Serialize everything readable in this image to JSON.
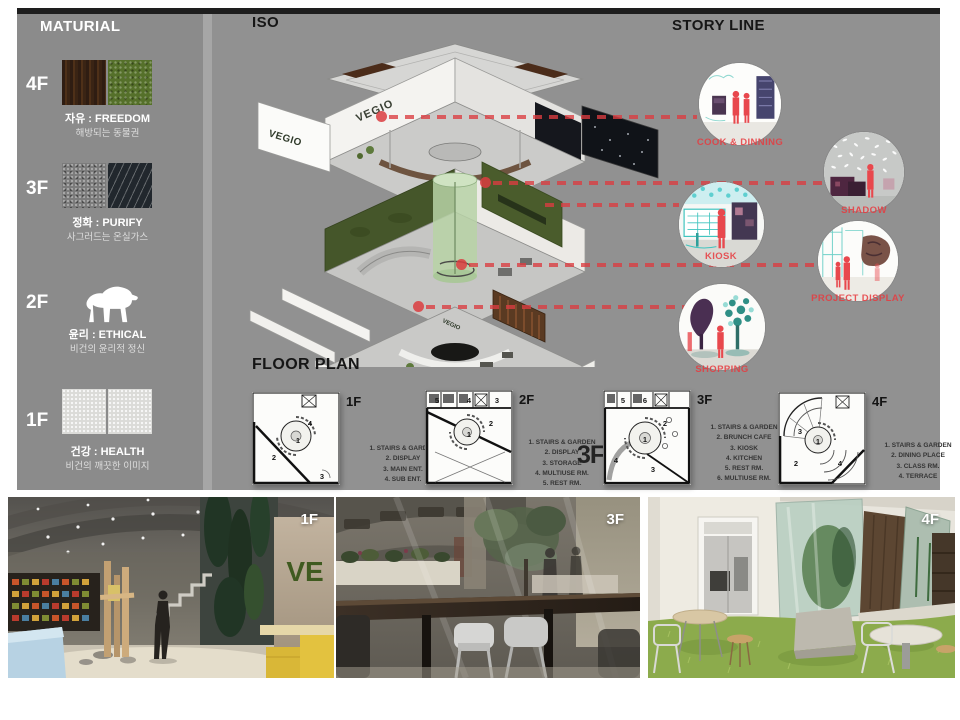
{
  "page": {
    "background": "#ffffff",
    "board_gray": "#919191",
    "sidebar_gray": "#8b8b8b",
    "accent_red": "#db3c40"
  },
  "sidebar": {
    "title": "MATURIAL",
    "items": [
      {
        "floor": "4F",
        "theme": "자유 : FREEDOM",
        "desc": "해방되는 동물권",
        "swatches": [
          "dark-wood",
          "green-grass"
        ]
      },
      {
        "floor": "3F",
        "theme": "정화 : PURIFY",
        "desc": "사그러드는 온실가스",
        "swatches": [
          "gray-concrete",
          "rain-streak"
        ]
      },
      {
        "floor": "2F",
        "theme": "윤리 : ETHICAL",
        "desc": "비건의 윤리적 정신",
        "icon": "polar-bear"
      },
      {
        "floor": "1F",
        "theme": "건강 : HEALTH",
        "desc": "비건의 깨끗한 이미지",
        "swatches": [
          "white-plaster",
          "white-plaster"
        ]
      }
    ]
  },
  "iso": {
    "title": "ISO",
    "logo": "VEGIO"
  },
  "storyline": {
    "title": "STORY LINE",
    "scenes": [
      {
        "label": "COOK & DINNING"
      },
      {
        "label": "SHADOW"
      },
      {
        "label": "KIOSK"
      },
      {
        "label": "PROJECT DISPLAY"
      },
      {
        "label": "SHOPPING"
      }
    ]
  },
  "floorplan": {
    "title": "FLOOR PLAN",
    "big_label": "3F",
    "plans": [
      {
        "floor": "1F",
        "rooms": [
          "1",
          "2",
          "3",
          "4"
        ],
        "legend": [
          "1. STAIRS & GARDEN",
          "2. DISPLAY",
          "3. MAIN ENT.",
          "4. SUB ENT."
        ]
      },
      {
        "floor": "2F",
        "rooms": [
          "1",
          "2",
          "3",
          "4",
          "5"
        ],
        "legend": [
          "1. STAIRS & GARDEN",
          "2. DISPLAY",
          "3. STORAGE",
          "4. MULTIUSE RM.",
          "5. REST RM."
        ]
      },
      {
        "floor": "3F",
        "rooms": [
          "1",
          "2",
          "3",
          "4",
          "5",
          "6"
        ],
        "legend": [
          "1. STAIRS & GARDEN",
          "2. BRUNCH CAFE",
          "3. KIOSK",
          "4. KITCHEN",
          "5. REST RM.",
          "6. MULTIUSE RM."
        ]
      },
      {
        "floor": "4F",
        "rooms": [
          "1",
          "2",
          "3",
          "4"
        ],
        "legend": [
          "1. STAIRS & GARDEN",
          "2. DINING PLACE",
          "3. CLASS RM.",
          "4. TERRACE"
        ]
      }
    ]
  },
  "photos": [
    {
      "label": "1F",
      "sign": "VE"
    },
    {
      "label": "3F"
    },
    {
      "label": "4F"
    }
  ]
}
